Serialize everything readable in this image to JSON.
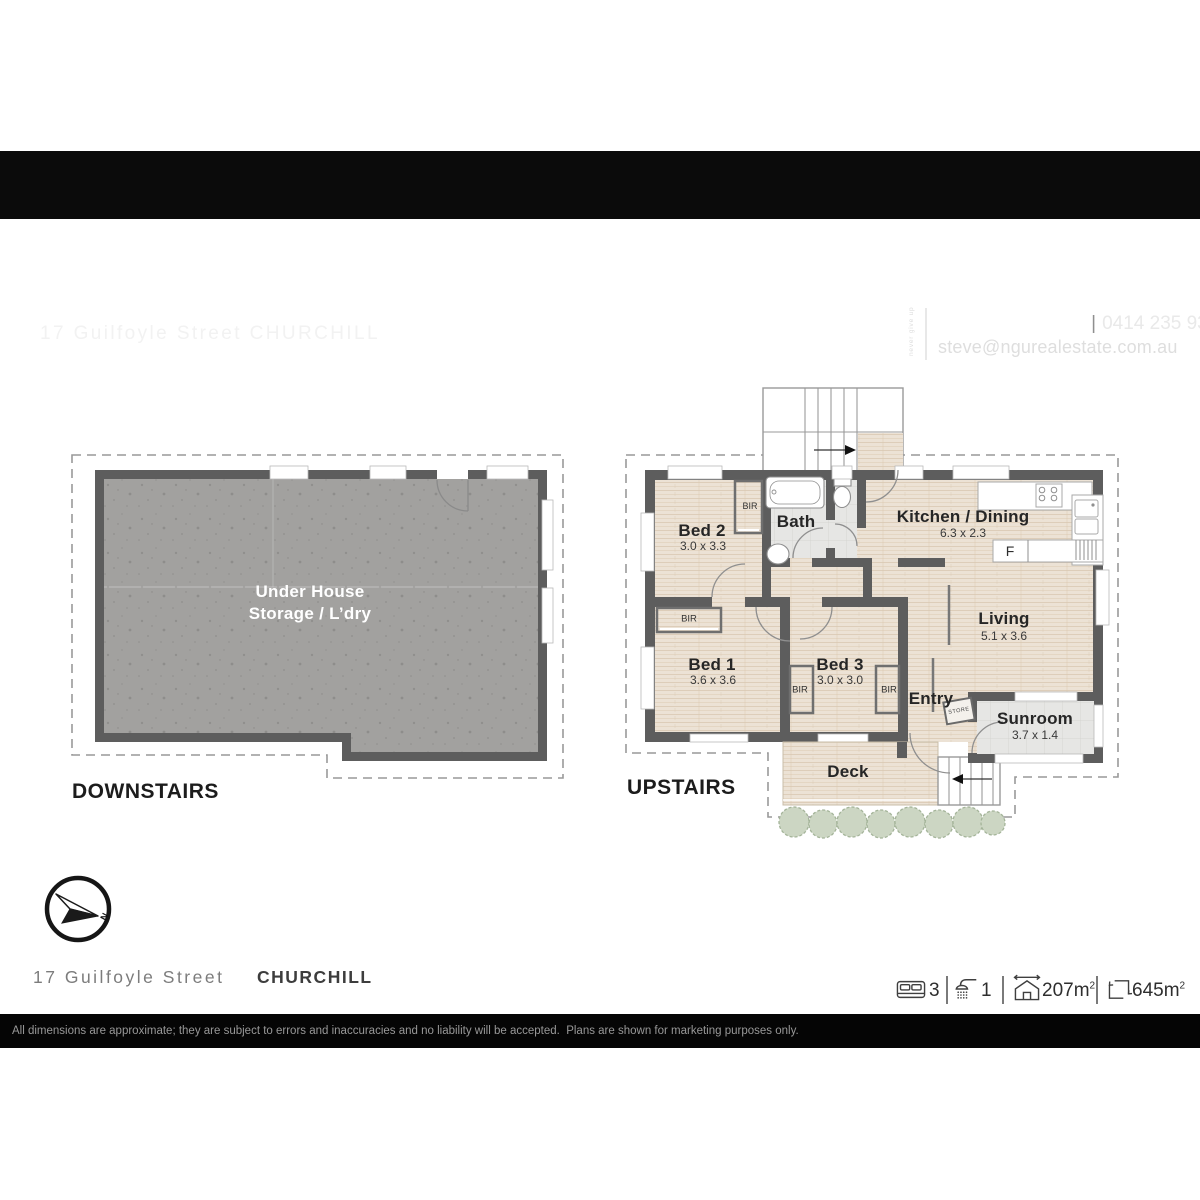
{
  "header": {
    "address": "17 Guilfoyle Street CHURCHILL",
    "logo": {
      "name": "NGU",
      "tagline": "REAL ESTATE",
      "slogan": "never give up"
    },
    "agent": {
      "name": "Steve Athanates",
      "pipe": "|",
      "phone": "0414 235 933",
      "email": "steve@ngurealestate.com.au"
    }
  },
  "downstairs": {
    "title": "DOWNSTAIRS",
    "room": {
      "line1": "Under House",
      "line2": "Storage / L’dry"
    }
  },
  "upstairs": {
    "title": "UPSTAIRS",
    "rooms": {
      "bed2": {
        "name": "Bed 2",
        "dims": "3.0 x 3.3"
      },
      "bath": {
        "name": "Bath"
      },
      "kitchen": {
        "name": "Kitchen / Dining",
        "dims": "6.3 x 2.3"
      },
      "bed1": {
        "name": "Bed 1",
        "dims": "3.6 x 3.6"
      },
      "bed3": {
        "name": "Bed 3",
        "dims": "3.0 x 3.0"
      },
      "living": {
        "name": "Living",
        "dims": "5.1 x 3.6"
      },
      "entry": {
        "name": "Entry"
      },
      "sunroom": {
        "name": "Sunroom",
        "dims": "3.7 x 1.4"
      },
      "deck": {
        "name": "Deck"
      }
    },
    "closet_label": "BIR",
    "store_label": "STORE",
    "fridge_label": "F"
  },
  "compass": {
    "north": "N"
  },
  "address_footer": {
    "street": "17 Guilfoyle Street",
    "suburb": "CHURCHILL"
  },
  "stats": {
    "beds": "3",
    "showers": "1",
    "house_area": "207m",
    "house_area_sup": "2",
    "land_area": "645m",
    "land_area_sup": "2"
  },
  "disclaimer": "All dimensions are approximate; they are subject to errors and inaccuracies and no liability will be accepted.  Plans are shown for marketing purposes only.",
  "colors": {
    "bar": "#0b0b0b",
    "wall": "#5d5d5d",
    "wood": "#ece2d5",
    "concrete": "#a2a19f",
    "tile": "#e6e6e4",
    "shrub": "#ccd6c3",
    "dash": "#999999"
  }
}
